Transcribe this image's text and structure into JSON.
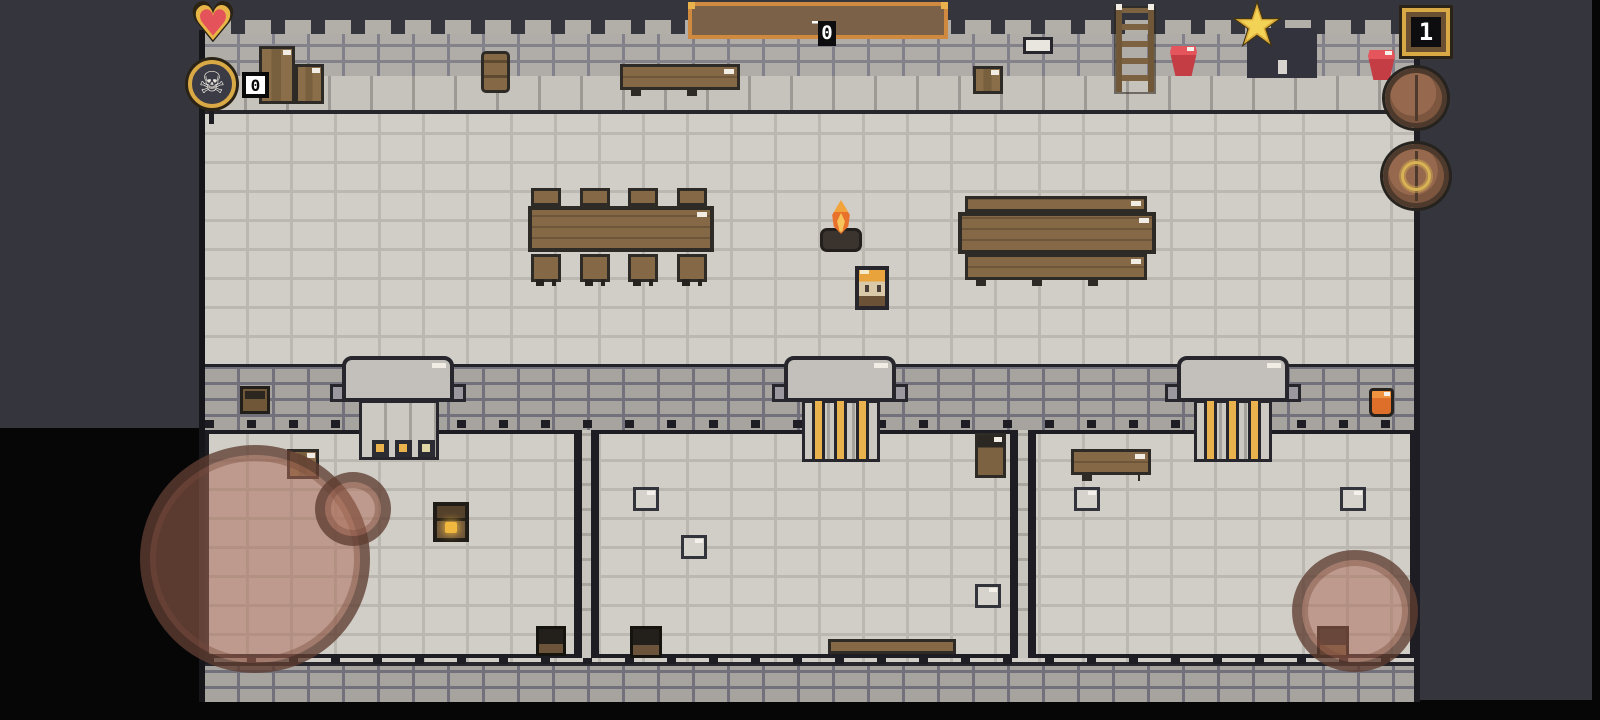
{
  "hud": {
    "hearts": {
      "count": 3
    },
    "skull_counter": {
      "value": "0"
    },
    "timer": {
      "elapsed": "00:09",
      "separator": "–",
      "total": "05:00"
    },
    "stars": {
      "count": 3
    },
    "level_badge": {
      "value": "1"
    }
  },
  "icons": {
    "heart": "♥",
    "star": "★",
    "skull": "☠"
  },
  "colors": {
    "background": "#35353e",
    "floor": "#d1cec8",
    "wall_brick": "#a7a49f",
    "wood": "#856947",
    "heart_red": "#e4525a",
    "gold": "#e9b24c",
    "bucket_red": "#d94a50",
    "flame_orange": "#e8722c",
    "barrel_overlay": "rgba(170,108,86,0.52)"
  }
}
